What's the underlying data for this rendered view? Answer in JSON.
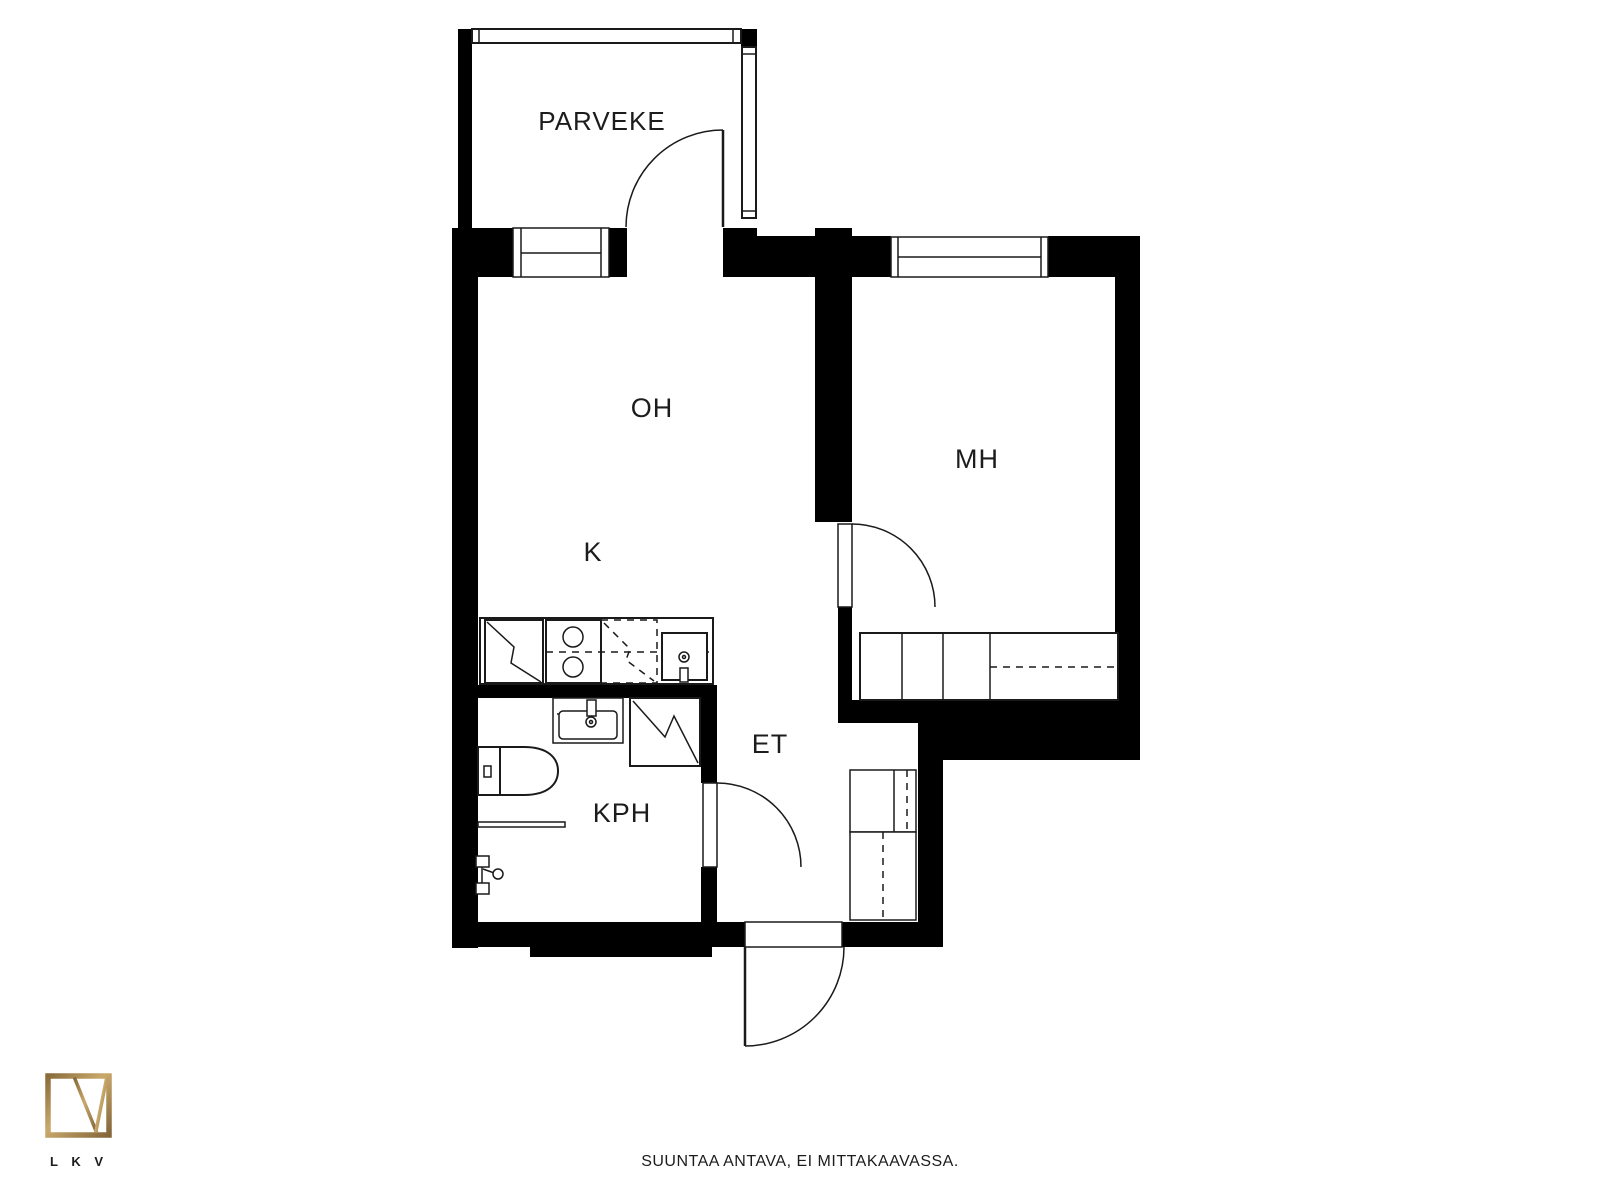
{
  "rooms": {
    "balcony": "PARVEKE",
    "living": "OH",
    "kitchen": "K",
    "bedroom": "MH",
    "hall": "ET",
    "bathroom": "KPH"
  },
  "fixtures": [
    "refrigerator",
    "stove",
    "dishwasher",
    "kitchen-sink",
    "bathroom-sink",
    "washing-machine",
    "toilet",
    "towel-rail",
    "shower-mixer",
    "wardrobe",
    "closet",
    "window",
    "door"
  ],
  "footer": {
    "disclaimer": "SUUNTAA ANTAVA, EI MITTAKAAVASSA.",
    "logo_caption": "L K V"
  },
  "colors": {
    "wall": "#000000",
    "line": "#1a1a1a",
    "text": "#1c1c1c",
    "background": "#ffffff",
    "logo_gold": "#a3834f",
    "logo_gold_dark": "#84663a",
    "logo_gold_light": "#c9a96b"
  }
}
